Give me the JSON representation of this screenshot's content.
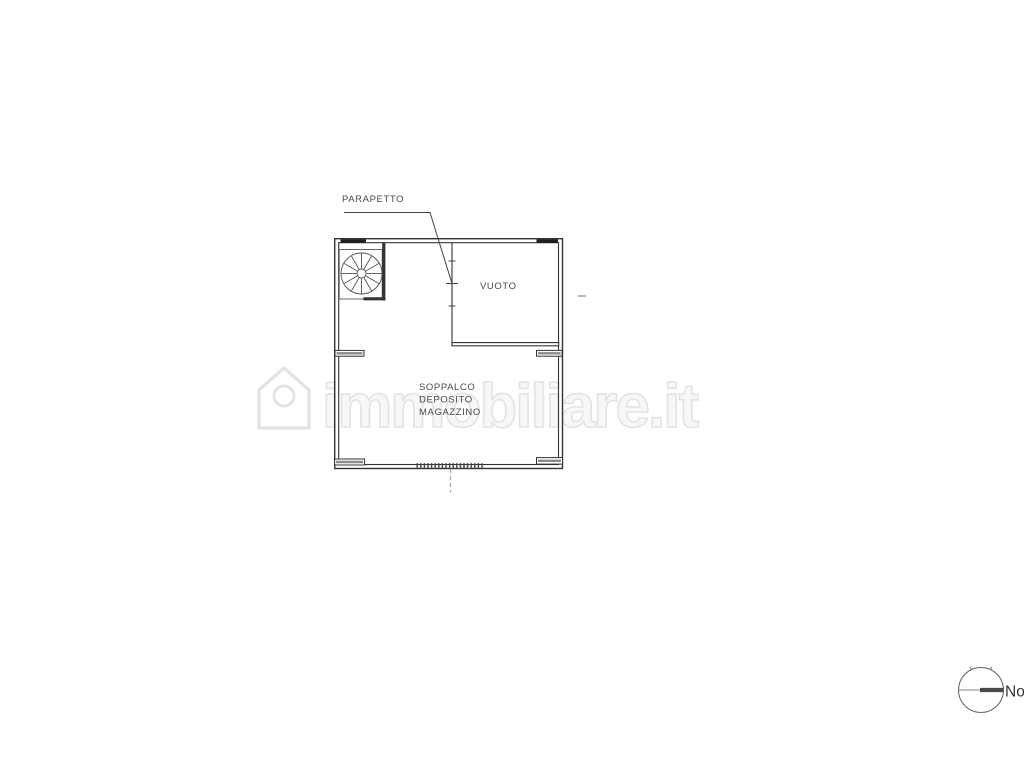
{
  "floor_plan": {
    "labels": {
      "parapetto": "PARAPETTO",
      "vuoto": "VUOTO",
      "room_line1": "SOPPALCO",
      "room_line2": "DEPOSITO",
      "room_line3": "MAGAZZINO"
    }
  },
  "compass": {
    "north_label": "Nord"
  },
  "watermark": {
    "text": "immobiliare.it"
  },
  "colors": {
    "wall_line": "#333333",
    "thin_line": "#555555",
    "label_text": "#4a4a4a",
    "watermark": "#e3e3e3",
    "background": "#ffffff"
  }
}
